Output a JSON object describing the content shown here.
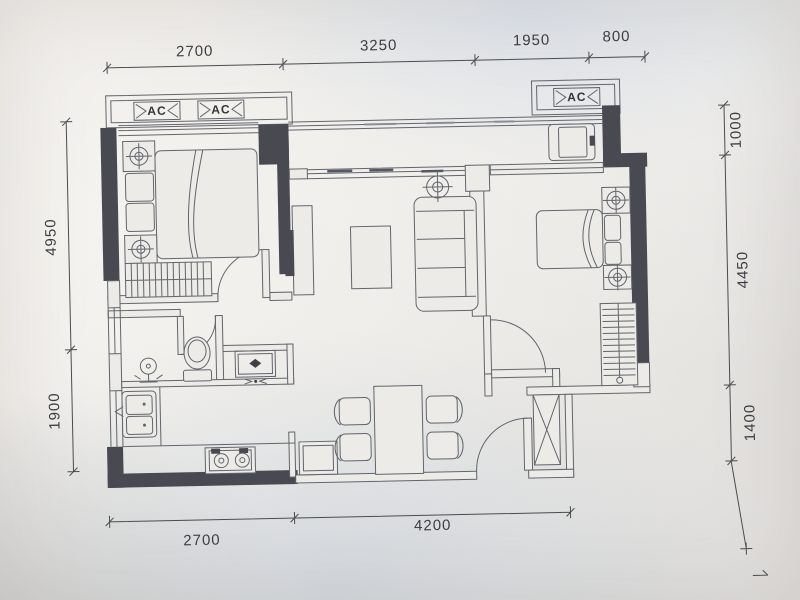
{
  "dims": {
    "top": [
      "2700",
      "3250",
      "1950",
      "800"
    ],
    "left": [
      "4950",
      "1900"
    ],
    "right": [
      "1000",
      "4450",
      "1400"
    ],
    "bottom": [
      "2700",
      "4200"
    ]
  },
  "ac_units": [
    "AC",
    "AC",
    "AC"
  ],
  "colors": {
    "paper": "#e9e7e3",
    "line": "#62656d",
    "wall": "#494951",
    "dim_text": "#3c3d41"
  }
}
